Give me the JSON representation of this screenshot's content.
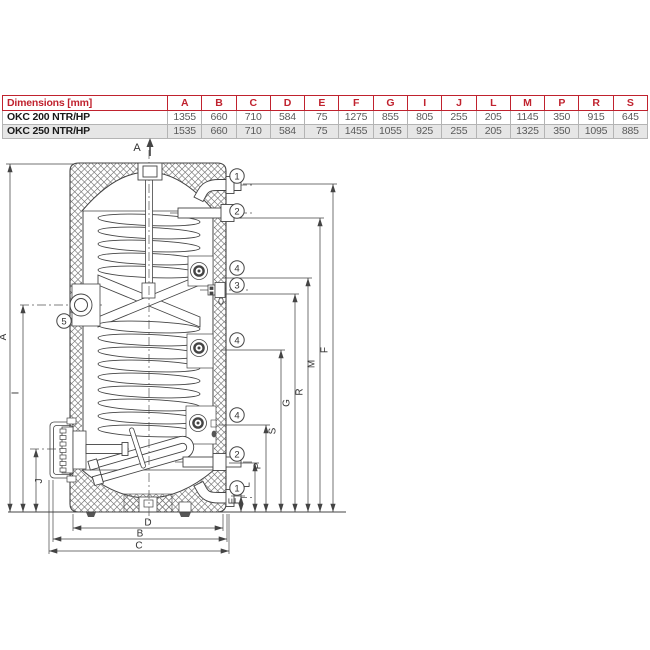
{
  "table": {
    "header_label": "Dimensions [mm]",
    "columns": [
      "A",
      "B",
      "C",
      "D",
      "E",
      "F",
      "G",
      "I",
      "J",
      "L",
      "M",
      "P",
      "R",
      "S"
    ],
    "rows": [
      {
        "model": "OKC 200 NTR/HP",
        "values": [
          "1355",
          "660",
          "710",
          "584",
          "75",
          "1275",
          "855",
          "805",
          "255",
          "205",
          "1145",
          "350",
          "915",
          "645"
        ]
      },
      {
        "model": "OKC 250 NTR/HP",
        "values": [
          "1535",
          "660",
          "710",
          "584",
          "75",
          "1455",
          "1055",
          "925",
          "255",
          "205",
          "1325",
          "350",
          "1095",
          "885"
        ]
      }
    ],
    "accent_color": "#c0222e",
    "alt_row_color": "#e6e6e6"
  },
  "diagram": {
    "section_label": "A",
    "left_dims": [
      "A",
      "I",
      "J"
    ],
    "right_dims": [
      "E",
      "L",
      "P",
      "S",
      "G",
      "R",
      "M",
      "F"
    ],
    "bottom_dims": [
      "D",
      "B",
      "C"
    ],
    "callouts_right": [
      "1",
      "2",
      "4",
      "3",
      "4",
      "4",
      "2",
      "1"
    ],
    "callout_left": "5",
    "line_color": "#444444"
  }
}
